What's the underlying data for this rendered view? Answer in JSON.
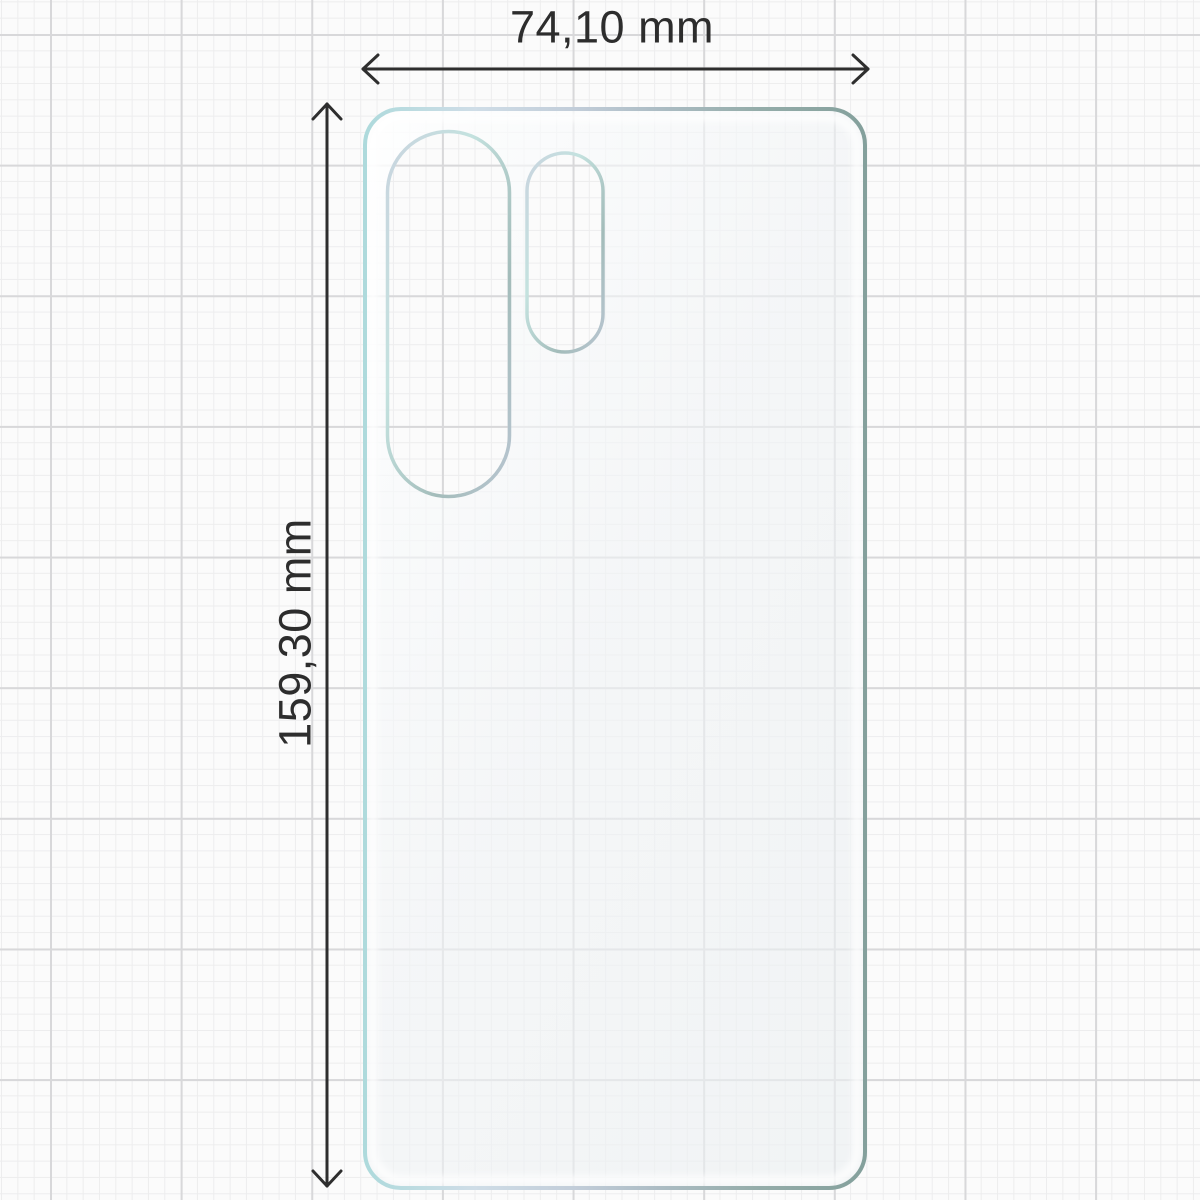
{
  "diagram": {
    "title": "screen-protector-film-dimension-diagram",
    "width_label": "74,10 mm",
    "height_label": "159,30 mm",
    "width_mm": "74,10",
    "height_mm": "159,30",
    "unit": "mm",
    "colors": {
      "paper_background": "#fbfbfb",
      "grid_minor": "#ededee",
      "grid_major": "#d8d8da",
      "dimension_text": "#2d2d2d",
      "dimension_line": "#2e2e2e",
      "film_edge_cyan": "#aedadc",
      "film_edge_silver": "#c2cdd9",
      "film_edge_teal_gray": "#84a09c",
      "film_fill_tint": "#f3f4f6"
    },
    "icons": {
      "width_arrow": "double-headed-horizontal-arrow",
      "height_arrow": "double-headed-vertical-arrow"
    }
  }
}
